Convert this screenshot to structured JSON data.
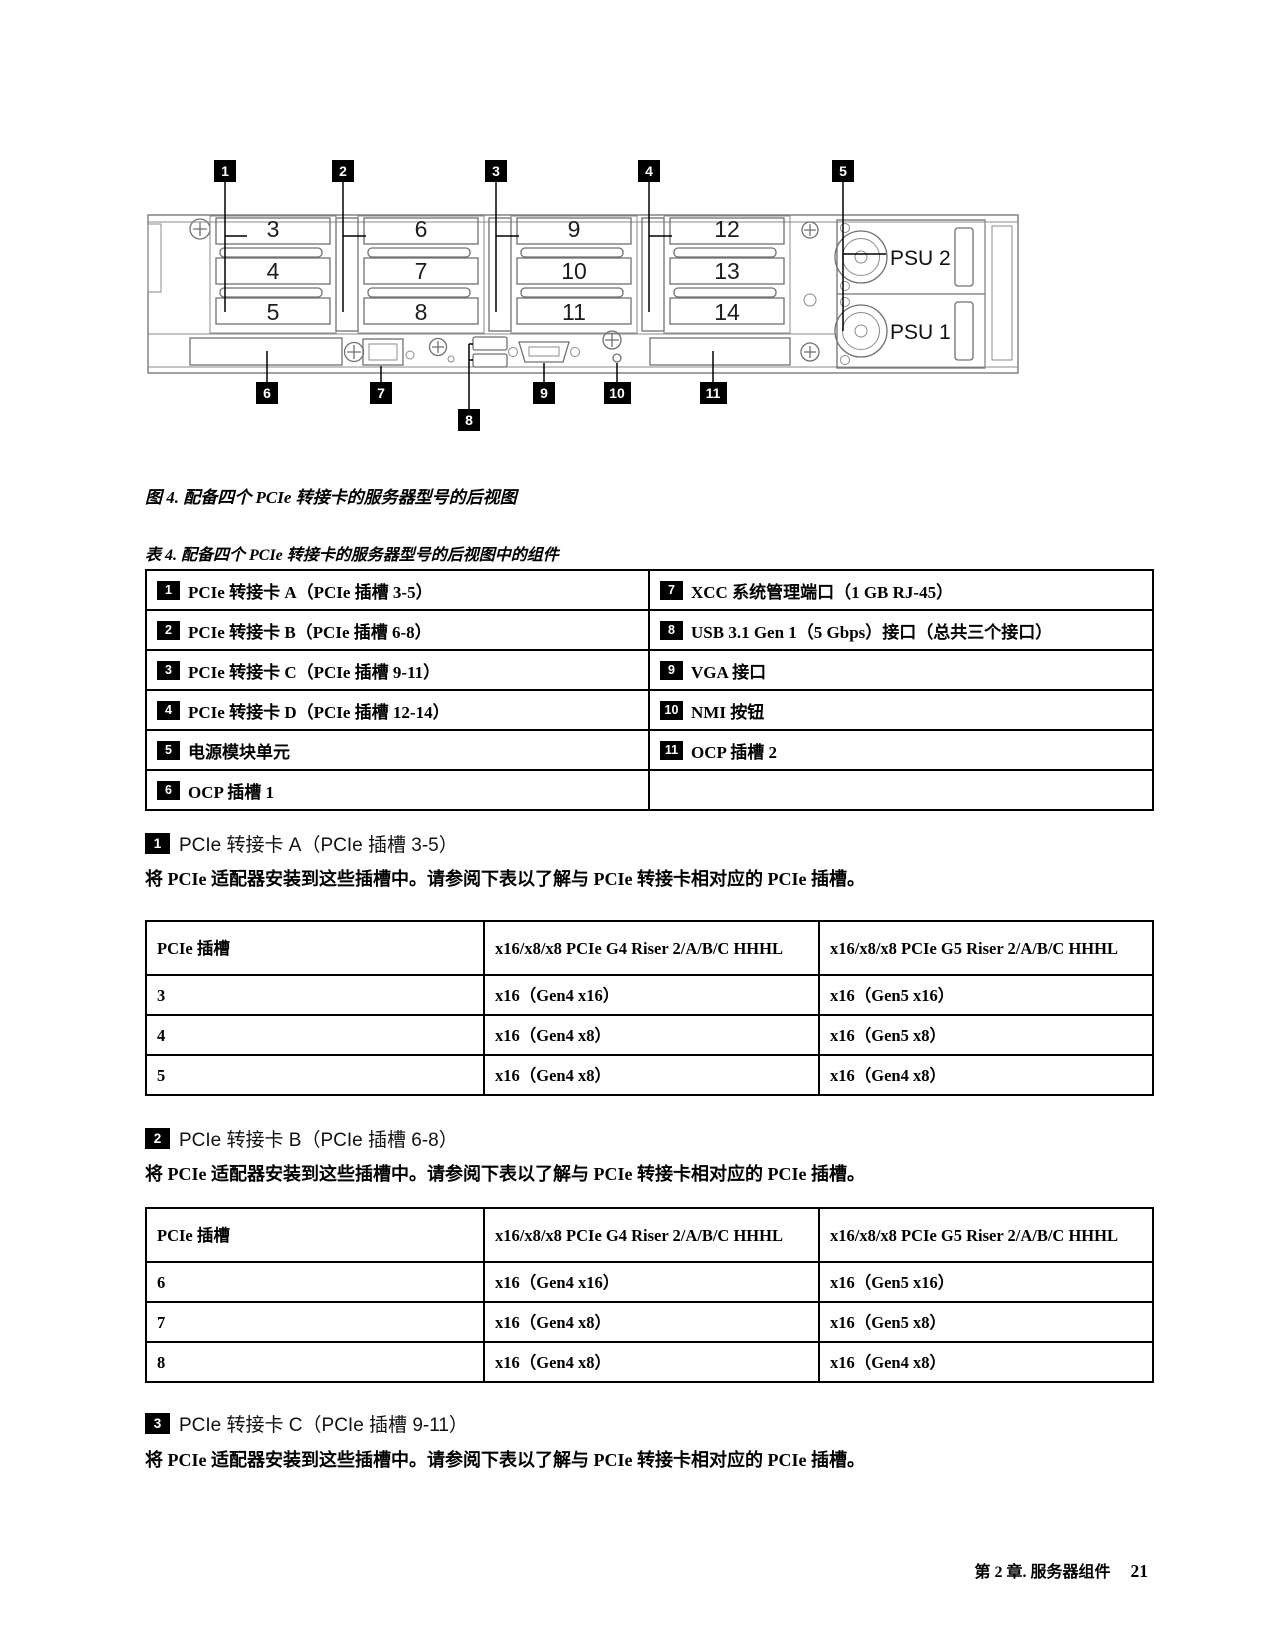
{
  "diagram": {
    "callouts": [
      "1",
      "2",
      "3",
      "4",
      "5",
      "6",
      "7",
      "8",
      "9",
      "10",
      "11"
    ],
    "slots": [
      "3",
      "4",
      "5",
      "6",
      "7",
      "8",
      "9",
      "10",
      "11",
      "12",
      "13",
      "14"
    ],
    "psu": [
      "PSU 2",
      "PSU 1"
    ]
  },
  "figure_caption": "图 4. 配备四个 PCIe 转接卡的服务器型号的后视图",
  "component_table": {
    "caption": "表 4. 配备四个 PCIe 转接卡的服务器型号的后视图中的组件",
    "rows": [
      {
        "ln": "1",
        "lt": "PCIe 转接卡 A（PCIe 插槽 3-5）",
        "rn": "7",
        "rt": "XCC 系统管理端口（1 GB RJ-45）"
      },
      {
        "ln": "2",
        "lt": "PCIe 转接卡 B（PCIe 插槽 6-8）",
        "rn": "8",
        "rt": "USB 3.1 Gen 1（5 Gbps）接口（总共三个接口）"
      },
      {
        "ln": "3",
        "lt": "PCIe 转接卡 C（PCIe 插槽 9-11）",
        "rn": "9",
        "rt": "VGA 接口"
      },
      {
        "ln": "4",
        "lt": "PCIe 转接卡 D（PCIe 插槽 12-14）",
        "rn": "10",
        "rt": "NMI 按钮"
      },
      {
        "ln": "5",
        "lt": "电源模块单元",
        "rn": "11",
        "rt": "OCP 插槽 2"
      },
      {
        "ln": "6",
        "lt": "OCP 插槽 1",
        "rn": "",
        "rt": ""
      }
    ]
  },
  "sections": [
    {
      "num": "1",
      "title": "PCIe 转接卡 A（PCIe 插槽 3-5）",
      "body": "将 PCIe 适配器安装到这些插槽中。请参阅下表以了解与 PCIe 转接卡相对应的 PCIe 插槽。",
      "table": {
        "headers": [
          "PCIe 插槽",
          "x16/x8/x8 PCIe G4 Riser 2/A/B/C HHHL",
          "x16/x8/x8 PCIe G5 Riser 2/A/B/C HHHL"
        ],
        "rows": [
          [
            "3",
            "x16（Gen4 x16）",
            "x16（Gen5 x16）"
          ],
          [
            "4",
            "x16（Gen4 x8）",
            "x16（Gen5 x8）"
          ],
          [
            "5",
            "x16（Gen4 x8）",
            "x16（Gen4 x8）"
          ]
        ]
      }
    },
    {
      "num": "2",
      "title": "PCIe 转接卡 B（PCIe 插槽 6-8）",
      "body": "将 PCIe 适配器安装到这些插槽中。请参阅下表以了解与 PCIe 转接卡相对应的 PCIe 插槽。",
      "table": {
        "headers": [
          "PCIe 插槽",
          "x16/x8/x8 PCIe G4 Riser 2/A/B/C HHHL",
          "x16/x8/x8 PCIe G5 Riser 2/A/B/C HHHL"
        ],
        "rows": [
          [
            "6",
            "x16（Gen4 x16）",
            "x16（Gen5 x16）"
          ],
          [
            "7",
            "x16（Gen4 x8）",
            "x16（Gen5 x8）"
          ],
          [
            "8",
            "x16（Gen4 x8）",
            "x16（Gen4 x8）"
          ]
        ]
      }
    },
    {
      "num": "3",
      "title": "PCIe 转接卡 C（PCIe 插槽 9-11）",
      "body": "将 PCIe 适配器安装到这些插槽中。请参阅下表以了解与 PCIe 转接卡相对应的 PCIe 插槽。"
    }
  ],
  "footer": {
    "chapter": "第 2 章. 服务器组件",
    "page": "21"
  }
}
